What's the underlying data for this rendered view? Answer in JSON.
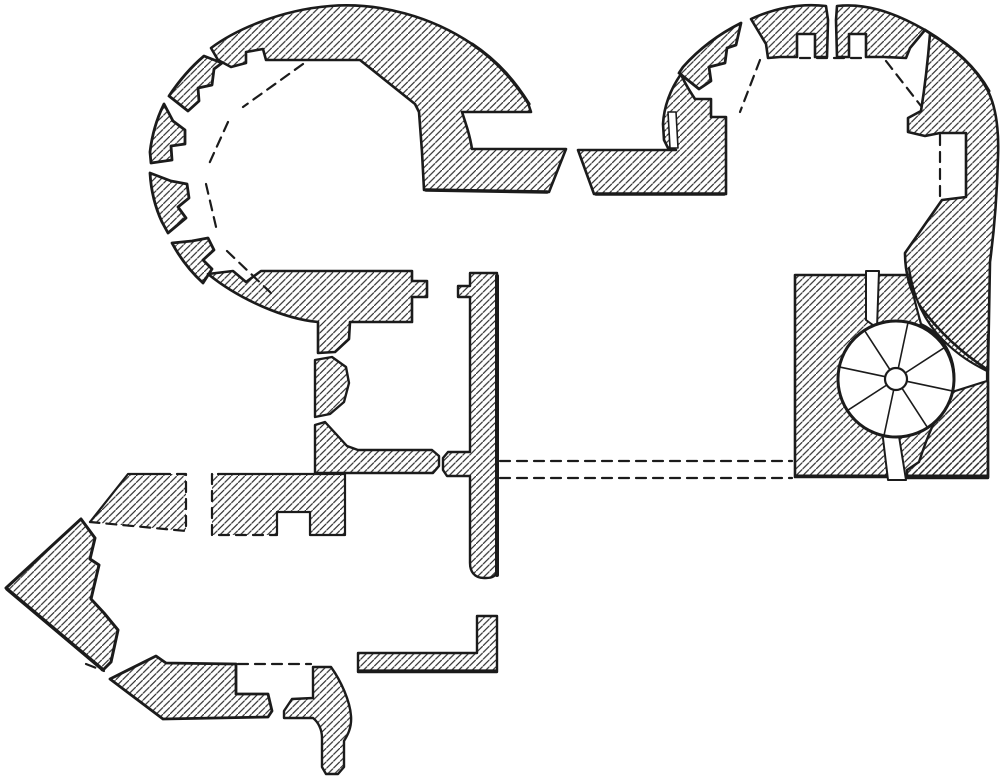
{
  "palette": {
    "paper": "#ffffff",
    "ink": "#1b1b1b",
    "hatch_ink": "#2b2b2b"
  },
  "hatch": {
    "spacing": 6.8,
    "line_width": 1.15
  },
  "canvas": {
    "width": 1000,
    "height": 782
  },
  "drawing": {
    "hatched": [
      {
        "name": "tower-left-wall",
        "w": 2.6,
        "d": "M 211,48 C 235,30 280,10 330,6 C 380,2 432,17 472,44 C 497,61 514,81 528,103 L 531,112 L 462,112 C 466,124 470,136 472,149 L 566,149 L 549,192 L 424,190 L 422,152 C 421,138 420,124 419,112 L 415,104 L 360,60 L 266,60 L 263,49 L 246,52 L 246,63 L 231,67 L 218,60 Z"
      },
      {
        "name": "tower-left-merlon-nw",
        "w": 2.8,
        "d": "M 204,56 C 191,67 179,81 169,96 L 188,111 L 199,101 L 198,88 L 212,85 L 214,69 L 222,63 Z"
      },
      {
        "name": "tower-left-merlon-w",
        "w": 2.8,
        "d": "M 164,104 C 157,118 152,135 150,152 L 151,163 L 172,160 L 171,146 L 185,144 L 185,130 L 173,121 Z"
      },
      {
        "name": "tower-left-merlon-sw",
        "w": 2.8,
        "d": "M 150,173 C 151,190 155,207 162,222 L 168,233 L 186,218 L 178,207 L 189,198 L 187,184 L 171,181 Z"
      },
      {
        "name": "tower-left-merlon-s",
        "w": 2.8,
        "d": "M 172,243 C 180,258 191,272 203,283 L 212,269 L 203,260 L 214,250 L 208,238 L 192,241 Z"
      },
      {
        "name": "tower-left-south-wall",
        "w": 2.6,
        "d": "M 208,274 L 233,271 L 246,282 L 261,271 L 412,271 L 412,281 L 427,281 L 427,297 L 412,297 L 412,322 L 350,322 L 349,339 L 335,352 L 318,353 L 318,322 C 285,319 240,300 208,274 Z"
      },
      {
        "name": "pier-middle",
        "w": 2.4,
        "d": "M 315,360 L 332,357 L 346,367 L 349,383 L 344,402 L 330,414 L 315,417 Z"
      },
      {
        "name": "pier-lower-cross-wall",
        "w": 2.4,
        "d": "M 315,425 L 325,422 L 336,434 L 347,446 L 358,450 L 432,450 L 439,456 L 439,466 L 433,473 L 315,473 Z"
      },
      {
        "name": "central-spine-wall",
        "w": 2.4,
        "d": "M 470,273 L 497,273 L 497,570 C 497,576 492,578 486,578 L 484,578 C 474,578 470,571 470,563 L 470,476 L 447,476 L 443,470 L 443,458 L 448,452 L 470,452 L 470,297 L 458,297 L 458,286 L 470,286 Z"
      },
      {
        "name": "beak-bastion-upper",
        "w": 3,
        "d": "M 81,519 L 95,538 L 90,559 L 99,565 L 91,599 L 104,613 L 118,630 L 111,662 L 103,670 L 6,588 Z"
      },
      {
        "name": "beak-bastion-lower-wall",
        "w": 2.8,
        "d": "M 110,679 L 156,656 L 166,663 L 236,664 L 236,694 L 268,694 L 272,711 L 268,717 L 163,719 Z"
      },
      {
        "name": "outwork-dashed-left-fill",
        "w": 0,
        "d": "M 90,522 L 128,474 L 186,474 L 186,531 Z"
      },
      {
        "name": "outwork-dashed-mid-fill",
        "w": 0,
        "d": "M 212,474 L 345,474 L 345,535 L 310,535 L 310,512 L 277,512 L 277,535 L 212,535 Z"
      },
      {
        "name": "curved-pier-south",
        "w": 2.4,
        "d": "M 313,667 L 331,667 C 341,681 350,701 351,716 C 352,728 347,736 344,741 L 344,767 L 338,774 L 326,774 L 322,767 L 322,738 C 322,729 318,722 313,718 L 284,718 L 284,711 L 292,699 L 313,698 Z"
      },
      {
        "name": "l-shaped-wall-south",
        "w": 2.4,
        "d": "M 358,653 L 477,653 L 477,616 L 497,616 L 497,672 L 358,672 Z"
      },
      {
        "name": "stair-block-fill",
        "w": 0,
        "d": "M 795,275 L 988,275 L 988,477 L 795,477 Z"
      },
      {
        "name": "tower-right-merlon-nw",
        "w": 2.6,
        "d": "M 826,6 C 800,3 775,8 751,19 L 766,44 L 768,58 L 780,57 L 797,57 L 797,34 L 815,34 L 815,57 L 827,57 L 828,20 Z"
      },
      {
        "name": "tower-right-merlon-w",
        "w": 2.8,
        "d": "M 741,23 C 719,34 699,49 683,67 L 679,73 L 699,89 L 711,81 L 709,67 L 725,63 L 727,48 L 736,45 Z"
      },
      {
        "name": "tower-right-merlon-ne",
        "w": 2.6,
        "d": "M 837,6 C 864,3 892,11 925,30 L 910,48 L 906,58 L 884,57 L 866,57 L 866,34 L 849,34 L 849,57 L 837,57 L 836,20 Z"
      },
      {
        "name": "tower-right-east-wall",
        "w": 2.6,
        "d": "M 930,34 C 955,48 975,67 987,89 C 996,106 999,131 998,157 C 997,196 994,232 990,262 L 988,370 C 962,353 939,332 920,306 C 910,292 905,272 905,253 L 942,200 L 966,197 L 966,133 L 940,133 L 925,136 L 908,132 L 908,118 L 921,111 C 925,86 928,59 930,34 Z"
      },
      {
        "name": "tower-right-west-gate-wall",
        "w": 2.6,
        "d": "M 681,74 C 670,90 664,106 663,124 L 664,140 L 668,148 L 676,150 L 578,150 L 594,194 L 726,194 L 726,117 L 711,117 L 711,99 L 695,99 C 689,90 684,82 681,74 Z"
      },
      {
        "name": "stair-block-lower-right",
        "w": 2.4,
        "d": "M 986,380 L 951,391 C 937,413 926,440 919,462 L 907,470 L 907,478 L 988,478 L 988,382 Z"
      }
    ],
    "solid_lines": [
      {
        "name": "stair-block-outline",
        "w": 2.6,
        "d": "M 905,275 L 795,275 L 795,477 L 988,477 L 988,335"
      },
      {
        "name": "outwork-mid-solid-edge",
        "w": 2.2,
        "d": "M 218,474 L 345,474 L 345,535 L 310,535 L 310,512 L 277,512 L 277,534"
      },
      {
        "name": "outwork-left-solid-edge",
        "w": 2.2,
        "d": "M 90,522 L 128,474 L 160,474"
      },
      {
        "name": "spine-wall-shadow-edge",
        "w": 4,
        "d": "M 497,276 L 497,575"
      },
      {
        "name": "gate-left-wall-shadow-edge",
        "w": 3.5,
        "d": "M 426,190 L 547,192"
      },
      {
        "name": "gate-right-wall-shadow-edge",
        "w": 3.5,
        "d": "M 596,194 L 724,194"
      },
      {
        "name": "l-wall-shadow-edge",
        "w": 3.2,
        "d": "M 359,671 L 496,671"
      },
      {
        "name": "beak-shadow-edge",
        "w": 3.5,
        "d": "M 7,589 L 102,669"
      },
      {
        "name": "stair-block-shadow-edge",
        "w": 3,
        "d": "M 796,476 L 987,476"
      },
      {
        "name": "tower-left-arc-heavy",
        "w": 3.2,
        "d": "M 472,44 C 499,62 516,83 529,104"
      },
      {
        "name": "tower-right-arc-heavy",
        "w": 3,
        "d": "M 925,30 C 955,48 977,69 989,91"
      }
    ],
    "white_overlays": [
      {
        "name": "gate-right-rebate-slit",
        "w": 1.6,
        "d": "M 668,112 L 676,112 L 678,148 L 670,148 Z"
      },
      {
        "name": "stair-entry-slit-top",
        "w": 2,
        "d": "M 866,271 L 879,271 L 877,328 L 866,320 Z"
      },
      {
        "name": "stair-passage-channel",
        "w": 2.2,
        "d": "M 909,268 C 914,300 925,322 943,340 C 959,356 973,364 987,371 L 987,381 L 952,392 A 58,58 0 0 0 921,324 C 916,306 911,288 909,268 Z"
      },
      {
        "name": "stair-exit-slit-bottom",
        "w": 2,
        "d": "M 882,430 L 898,430 L 906,480 L 888,480 Z"
      }
    ],
    "dashed_lines": [
      {
        "name": "tower-left-embrasure-chord-1",
        "d": "M 303,64 L 243,107"
      },
      {
        "name": "tower-left-embrasure-chord-2",
        "d": "M 228,122 L 209,164"
      },
      {
        "name": "tower-left-embrasure-chord-3",
        "d": "M 206,184 L 217,231"
      },
      {
        "name": "tower-left-embrasure-chord-4",
        "d": "M 227,251 L 271,293"
      },
      {
        "name": "tower-right-embrasure-chord-top",
        "d": "M 800,58 L 863,58"
      },
      {
        "name": "tower-right-embrasure-chord-west",
        "d": "M 760,60 L 740,112"
      },
      {
        "name": "tower-right-embrasure-chord-east",
        "d": "M 886,61 L 921,106"
      },
      {
        "name": "tower-right-recess-dashed-face",
        "d": "M 940,135 L 940,196"
      },
      {
        "name": "passage-dashed-upper",
        "d": "M 500,461 L 792,461"
      },
      {
        "name": "passage-dashed-lower",
        "d": "M 500,478 L 792,478"
      },
      {
        "name": "south-opening-dashed",
        "d": "M 238,664 L 311,664"
      },
      {
        "name": "beak-dashed-tick",
        "d": "M 86,664 L 104,671"
      },
      {
        "name": "outwork-left-dashed-edges",
        "d": "M 160,474 L 186,474 L 186,531 L 90,522"
      },
      {
        "name": "outwork-mid-dashed-edges",
        "d": "M 212,474 L 212,535 L 277,535"
      }
    ],
    "stair": {
      "cx": 896,
      "cy": 379,
      "r": 58,
      "newel_r": 11,
      "spokes": 8,
      "angle_offset_deg": 12,
      "rim_w": 3,
      "spoke_w": 1.6,
      "newel_w": 2.2
    }
  }
}
